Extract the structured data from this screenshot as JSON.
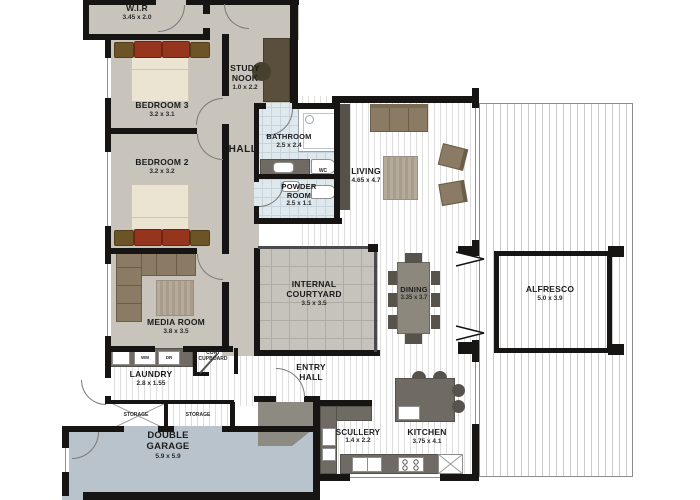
{
  "rooms": [
    {
      "id": "wir",
      "name": "W.I.R",
      "dims": "3.45 x 2.0"
    },
    {
      "id": "bedroom3",
      "name": "BEDROOM 3",
      "dims": "3.2 x 3.1"
    },
    {
      "id": "study_nook",
      "name": "STUDY NOOK",
      "dims": "1.0 x 2.2"
    },
    {
      "id": "hall",
      "name": "HALL",
      "dims": ""
    },
    {
      "id": "bathroom",
      "name": "BATHROOM",
      "dims": "2.5 x 2.4"
    },
    {
      "id": "bedroom2",
      "name": "BEDROOM 2",
      "dims": "3.2 x 3.2"
    },
    {
      "id": "powder_room",
      "name": "POWDER ROOM",
      "dims": "2.5 x 1.1"
    },
    {
      "id": "living",
      "name": "LIVING",
      "dims": "4.65 x 4.7"
    },
    {
      "id": "media_room",
      "name": "MEDIA ROOM",
      "dims": "3.8 x 3.5"
    },
    {
      "id": "internal_courtyard",
      "name": "INTERNAL COURTYARD",
      "dims": "3.5 x 3.5"
    },
    {
      "id": "dining",
      "name": "DINING",
      "dims": "3.35 x 3.7"
    },
    {
      "id": "alfresco",
      "name": "ALFRESCO",
      "dims": "5.0 x 3.9"
    },
    {
      "id": "laundry",
      "name": "LAUNDRY",
      "dims": "2.8 x 1.55"
    },
    {
      "id": "entry_hall",
      "name": "ENTRY HALL",
      "dims": ""
    },
    {
      "id": "scullery",
      "name": "SCULLERY",
      "dims": "1.4 x 2.2"
    },
    {
      "id": "kitchen",
      "name": "KITCHEN",
      "dims": "3.75 x 4.1"
    },
    {
      "id": "double_garage",
      "name": "DOUBLE GARAGE",
      "dims": "5.9 x 5.9"
    }
  ],
  "labels": {
    "coat_cupboard": "COAT CUPBOARD",
    "storage": "STORAGE",
    "wm": "WM",
    "dr": "DR",
    "wc": "WC"
  },
  "colors": {
    "wall": "#161514",
    "carpet": "#c8c4bc",
    "garage": "#b9c3cb",
    "bench": "#6f6b64",
    "sofa": "#8c7b64",
    "bathroom_tile": "#dfe8ed",
    "pillow_red": "#96351d",
    "floorboard_line": "#dedede"
  }
}
